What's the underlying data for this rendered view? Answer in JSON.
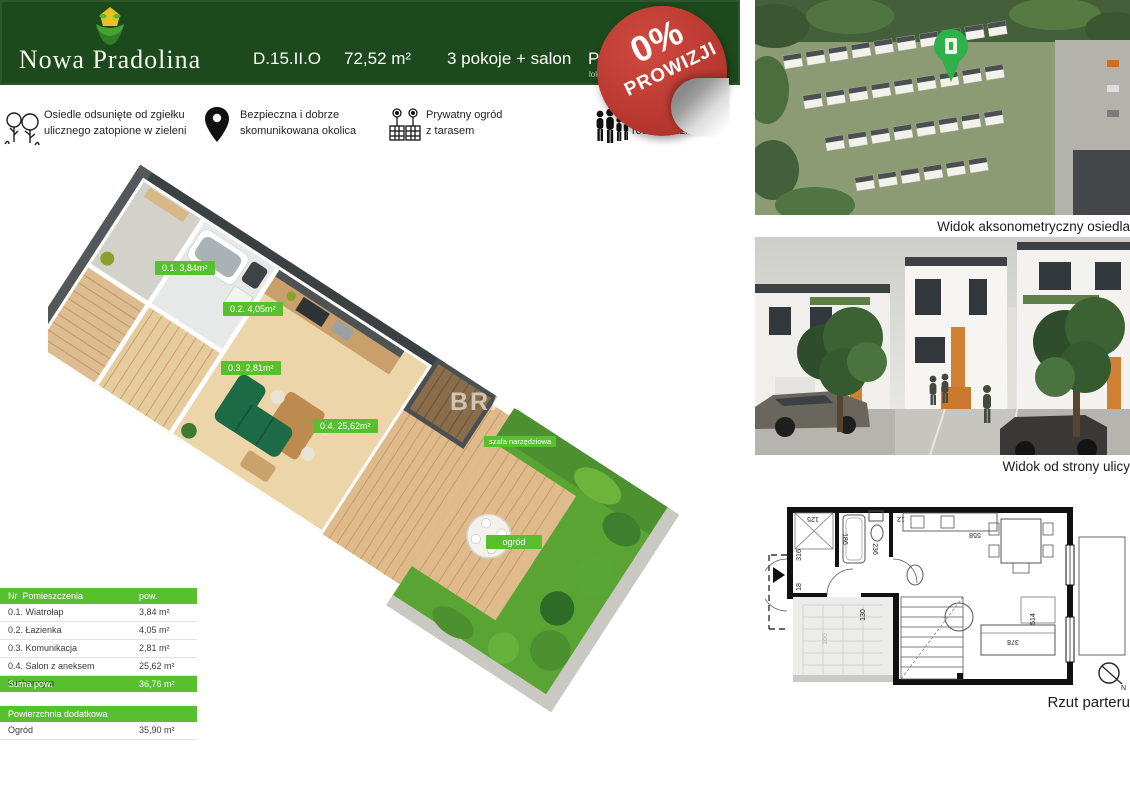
{
  "header": {
    "logo_title": "Nowa Pradolina",
    "unit_code": "D.15.II.O",
    "unit_area": "72,52 m²",
    "unit_rooms": "3 pokoje + salon",
    "partial_left": "Pa",
    "partial_right": "m²",
    "partial_sub": "lok",
    "bg_color": "#1c4a1c"
  },
  "badge": {
    "line1": "0%",
    "line2": "PROWIZJI",
    "color": "#bb3a31"
  },
  "features": [
    {
      "icon": "trees-icon",
      "lines": [
        "Osiedle odsunięte od zgiełku",
        "ulicznego zatopione  w zieleni"
      ]
    },
    {
      "icon": "map-pin-icon",
      "lines": [
        "Bezpieczna i dobrze",
        "skomunikowana okolica"
      ]
    },
    {
      "icon": "garden-planters-icon",
      "lines": [
        "Prywatny ogród",
        "z tarasem"
      ]
    },
    {
      "icon": "family-icon",
      "lines": [
        "zkanie idealne dla",
        "rodzin z dziećmi"
      ]
    }
  ],
  "plan3d": {
    "labels": [
      "0.1. 3,84m²",
      "0.2. 4,05m²",
      "0.3. 2,81m²",
      "0.4. 25,62m²",
      "szafa narzędziowa",
      "ogród"
    ],
    "watermark": "BRACIA",
    "label_color": "#58c02e"
  },
  "room_table": {
    "header": {
      "col1": "Nr",
      "col2": "Pomieszczenia",
      "col3": "pow."
    },
    "rows": [
      {
        "name": "0.1. Wiatrołap",
        "value": "3,84 m²"
      },
      {
        "name": "0.2. Łazienka",
        "value": "4,05 m²"
      },
      {
        "name": "0.3. Komunikacja",
        "value": "2,81 m²"
      },
      {
        "name": "0.4. Salon z aneksem kuchennym",
        "value": "25,62 m²"
      }
    ],
    "sum_label": "Suma pow.",
    "sum_value": "36,76 m²",
    "extra_header": "Powierzchnia dodatkowa",
    "extra_name": "Ogród",
    "extra_value": "35,90 m²"
  },
  "captions": {
    "axon": "Widok aksonometryczny osiedla",
    "street": "Widok od strony ulicy",
    "plan": "Rzut parteru"
  },
  "floorplan": {
    "dims": [
      "125",
      "316",
      "18",
      "186",
      "236",
      "130",
      "12",
      "558",
      "514",
      "378",
      "160"
    ],
    "compass": "N"
  }
}
